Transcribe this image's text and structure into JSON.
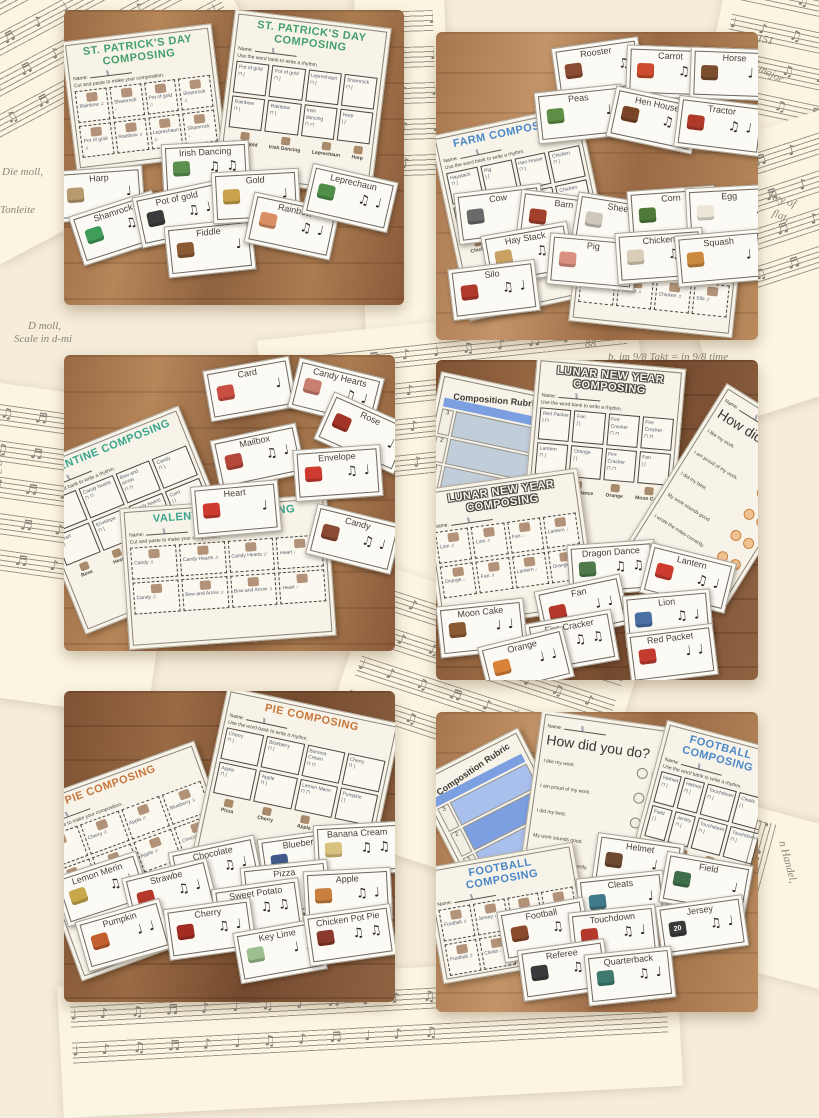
{
  "labels": {
    "name": "Name:",
    "wordbank_instruction": "Use the word bank to write a rhythm.",
    "cutpaste_instruction": "Cut and paste to make your composition."
  },
  "shared": {
    "rubric": {
      "title": "Composition Rubric",
      "scores": [
        "3",
        "2",
        "1"
      ]
    },
    "survey": {
      "title": "How did you do?",
      "items": [
        "I like my work.",
        "I am proud of my work.",
        "I did my best.",
        "My work sounds good.",
        "I wrote the notes correctly."
      ]
    }
  },
  "decor": {
    "notes": "♩ ♪ ♫ ♬ ♪ ♩ ♫ ♪ ♬ ♩ ♪ ♫",
    "fragments": [
      "151",
      "major",
      "Key of",
      "flat,",
      "88",
      "b. im 9/8 Takt = in 9/8 time",
      "Die moll,",
      "Tonleite",
      "D moll,",
      "Scale in d-mi",
      "1 2 3 4",
      "moll.",
      "art von",
      "le in d-mi",
      "n Handel,"
    ]
  },
  "photos": {
    "stpatricks": {
      "title": "St. Patrick's Day Composing",
      "title_color": "#44a06b",
      "wordbank_cells": [
        "Pot of gold\n⊓ |",
        "Pot of gold\n⊓ |",
        "Leprechaun\n⊓ |",
        "Shamrock\n⊓ |",
        "Rainbow\n⊓ |",
        "Rainbow\n⊓ |",
        "Irish dancing\n⊓ ⊓",
        "Harp\n| |"
      ],
      "cutpaste_cells": [
        "Rainbow ♫",
        "Shamrock ♩",
        "Pot of gold ♫",
        "Shamrock ♫",
        "Pot of gold ♫",
        "Rainbow ♫",
        "Leprechaun ♫",
        "Shamrock ♩"
      ],
      "wordbank_row": [
        "Pot of gold",
        "Irish Dancing",
        "Leprechaun",
        "Harp"
      ],
      "cards": [
        {
          "label": "Irish Dancing",
          "rhythm": "♫ ♫",
          "color": "#5a8f4f"
        },
        {
          "label": "Harp",
          "rhythm": "♩",
          "color": "#b79b6e"
        },
        {
          "label": "Shamrock",
          "rhythm": "♫ ♩",
          "color": "#3f9c5a"
        },
        {
          "label": "Pot of gold",
          "rhythm": "♫ ♩",
          "color": "#3a3a3a"
        },
        {
          "label": "Fiddle",
          "rhythm": "♩",
          "color": "#8a5a33"
        },
        {
          "label": "Gold",
          "rhythm": "♩",
          "color": "#c9a24b"
        },
        {
          "label": "Rainbow",
          "rhythm": "♫ ♩",
          "color": "#d98f64"
        },
        {
          "label": "Leprechaun",
          "rhythm": "♫ ♩",
          "color": "#4f8f4a"
        }
      ]
    },
    "farm": {
      "title": "Farm Composing",
      "title_color": "#4a87c7",
      "wordbank_cells": [
        "Haystack\n⊓ |",
        "Pig\n| |",
        "Hen House\n⊓ |",
        "Chicken\n⊓ |",
        "Barn\n| |",
        "Barn\n| |",
        "Corn\n| |",
        "Chicken\n⊓ |"
      ],
      "cutpaste_cells": [
        "Cow ♩",
        "Pig ♩",
        "Barn ♩",
        "Horse ♩",
        "Barn ♩",
        "Tractor ♫",
        "Chicken ♫",
        "Silo ♫"
      ],
      "wordbank_row": [
        "Chicken",
        "Tractor",
        "Haystack",
        "Silo"
      ],
      "cards": [
        {
          "label": "Rooster",
          "rhythm": "♫",
          "color": "#8a4b33"
        },
        {
          "label": "Carrot",
          "rhythm": "♫ ♩",
          "color": "#cc4b2e"
        },
        {
          "label": "Horse",
          "rhythm": "♩ ♩",
          "color": "#7a4e2f"
        },
        {
          "label": "Peas",
          "rhythm": "♩",
          "color": "#5f8f46"
        },
        {
          "label": "Hen House",
          "rhythm": "♫ ♩",
          "color": "#7a4527"
        },
        {
          "label": "Tractor",
          "rhythm": "♫ ♩",
          "color": "#b03a2a"
        },
        {
          "label": "Cow",
          "rhythm": "♩",
          "color": "#6a6a6a"
        },
        {
          "label": "Barn",
          "rhythm": "♩",
          "color": "#a3402c"
        },
        {
          "label": "Sheep",
          "rhythm": "♩",
          "color": "#cfc9bd"
        },
        {
          "label": "Corn",
          "rhythm": "♩",
          "color": "#4f7a3a"
        },
        {
          "label": "Egg",
          "rhythm": "♩",
          "color": "#ece6d8"
        },
        {
          "label": "Hay Stack",
          "rhythm": "♫ ♩",
          "color": "#c9a163"
        },
        {
          "label": "Pig",
          "rhythm": "♩",
          "color": "#d9907f"
        },
        {
          "label": "Chicken",
          "rhythm": "♫ ♩",
          "color": "#d9cdb8"
        },
        {
          "label": "Squash",
          "rhythm": "♩",
          "color": "#cc8a3f"
        },
        {
          "label": "Silo",
          "rhythm": "♫ ♩",
          "color": "#b03a2a"
        }
      ]
    },
    "valentine": {
      "title": "Valentine Composing",
      "title_color": "#3aa58c",
      "wordbank_cells": [
        "Candy\n| |",
        "Candy hearts\n⊓ ⊓",
        "Bow and arrow\n⊓ ⊓",
        "Candy\n⊓ |",
        "Heart\n| |",
        "Envelope\n⊓ |",
        "Candy hearts\n⊓ ⊓",
        "Card\n| |"
      ],
      "cutpaste_cells": [
        "Candy ♫",
        "Candy Hearts ♫",
        "Candy Hearts ♫",
        "Heart ♩",
        "Candy ♫",
        "Bow and Arrow ♫",
        "Bow and Arrow ♫",
        "Heart ♩"
      ],
      "wordbank_row": [
        "Rose",
        "Heart",
        "Card",
        "Candy Hearts"
      ],
      "cards": [
        {
          "label": "Card",
          "rhythm": "♩",
          "color": "#c94f42"
        },
        {
          "label": "Candy Hearts",
          "rhythm": "♫ ♩",
          "color": "#c97f6f"
        },
        {
          "label": "Rose",
          "rhythm": "♩",
          "color": "#a33327"
        },
        {
          "label": "Mailbox",
          "rhythm": "♫ ♩",
          "color": "#b5473a"
        },
        {
          "label": "Envelope",
          "rhythm": "♫ ♩",
          "color": "#cc3b2e"
        },
        {
          "label": "Heart",
          "rhythm": "♩",
          "color": "#cc3b2e"
        },
        {
          "label": "Candy",
          "rhythm": "♫ ♩",
          "color": "#8a4a33"
        }
      ]
    },
    "lunar": {
      "title": "Lunar New Year Composing",
      "title_color": "#f7f3e9",
      "wordbank_cells": [
        "Red Packet\n| ⊓",
        "Fan\n| |",
        "Fire Cracker\n⊓ ⊓",
        "Fire Cracker\n⊓ ⊓",
        "Lantern\n⊓ |",
        "Orange\n| |",
        "Fire Cracker\n⊓ ⊓",
        "Fan\n| |"
      ],
      "cutpaste_cells": [
        "Lion ♫",
        "Lion ♫",
        "Fan ♩",
        "Lantern ♩",
        "Orange ♩",
        "Fan ♫",
        "Lantern ♩",
        "Orange ♩"
      ],
      "wordbank_row": [
        "Fan",
        "Dragon Dance",
        "Orange",
        "Moon Cake"
      ],
      "cards": [
        {
          "label": "Dragon Dance",
          "rhythm": "♫ ♫",
          "color": "#4f7a4a"
        },
        {
          "label": "Lantern",
          "rhythm": "♫ ♩",
          "color": "#cc3b2e"
        },
        {
          "label": "Fan",
          "rhythm": "♩ ♩",
          "color": "#b5382c"
        },
        {
          "label": "Lion",
          "rhythm": "♫ ♩",
          "color": "#4a6fa3"
        },
        {
          "label": "Moon Cake",
          "rhythm": "♩ ♩",
          "color": "#8a5a33"
        },
        {
          "label": "Fire Cracker",
          "rhythm": "♫ ♫",
          "color": "#b5382c"
        },
        {
          "label": "Orange",
          "rhythm": "♩ ♩",
          "color": "#d9823a"
        },
        {
          "label": "Red Packet",
          "rhythm": "♩ ♩",
          "color": "#c23b2e"
        }
      ]
    },
    "pie": {
      "title": "Pie Composing",
      "title_color": "#c8763a",
      "wordbank_cells": [
        "Cherry\n⊓ |",
        "Blueberry\n⊓ |",
        "Banana Cream\n⊓ ⊓",
        "Cherry\n⊓ |",
        "Apple\n⊓ |",
        "Apple\n⊓ |",
        "Lemon Merin\n⊓ ⊓",
        "Pumpkin\n| |"
      ],
      "cutpaste_cells": [
        "Pizza ♫",
        "Cherry ♫",
        "Apple ♫",
        "Blueberry ♫",
        "Pizza ♫",
        "Cherry ♫",
        "Apple ♫",
        "Chocolate ♫"
      ],
      "wordbank_row": [
        "Pizza",
        "Cherry",
        "Apple",
        "Blueberry"
      ],
      "cards": [
        {
          "label": "Chocolate",
          "rhythm": "♫ ♩",
          "color": "#5f3a27"
        },
        {
          "label": "Blueberry",
          "rhythm": "♫ ♩",
          "color": "#3f5a8a"
        },
        {
          "label": "Banana Cream",
          "rhythm": "♫ ♫",
          "color": "#d9c27f"
        },
        {
          "label": "Pizza",
          "rhythm": "♫",
          "color": "#c9803f"
        },
        {
          "label": "Lemon Merin",
          "rhythm": "♫ ♩",
          "color": "#c9a84b"
        },
        {
          "label": "Strawbe",
          "rhythm": "♫ ♩",
          "color": "#b5382c"
        },
        {
          "label": "Sweet Potato",
          "rhythm": "♫ ♫",
          "color": "#b54b33"
        },
        {
          "label": "Apple",
          "rhythm": "♫ ♩",
          "color": "#c9803f"
        },
        {
          "label": "Pumpkin",
          "rhythm": "♩ ♩",
          "color": "#c25f2e"
        },
        {
          "label": "Cherry",
          "rhythm": "♫ ♩",
          "color": "#a32c22"
        },
        {
          "label": "Key Lime",
          "rhythm": "♩ ♩",
          "color": "#9cbf8f"
        },
        {
          "label": "Chicken Pot Pie",
          "rhythm": "♫ ♫",
          "color": "#8a3a2c"
        }
      ]
    },
    "football": {
      "title": "Football Composing",
      "title_color": "#4a87c7",
      "wordbank_cells": [
        "Helmet\n⊓ |",
        "Helmet\n⊓ |",
        "Touchdown\n⊓ |",
        "Cleats\n| |",
        "Field\n| |",
        "Jersey\n⊓ |",
        "Touchdown\n⊓ |",
        "Touchdown\n⊓ |"
      ],
      "cutpaste_cells": [
        "Football ♫",
        "Jersey ♩",
        "Football ♩",
        "Helmet ♫",
        "Football ♫",
        "Cleats ♩",
        "Referee ♫",
        "Field ♩"
      ],
      "wordbank_row": [
        "Football",
        "Touchdown",
        "Cleats",
        "Helmet"
      ],
      "cards": [
        {
          "label": "Helmet",
          "rhythm": "♩ ♩",
          "color": "#6f4a33"
        },
        {
          "label": "Cleats",
          "rhythm": "♩",
          "color": "#3f7a8a"
        },
        {
          "label": "Field",
          "rhythm": "♩",
          "color": "#3f6f4a"
        },
        {
          "label": "Football",
          "rhythm": "♫ ♩",
          "color": "#8a4a2c"
        },
        {
          "label": "Touchdown",
          "rhythm": "♫ ♩",
          "color": "#b5382c"
        },
        {
          "label": "Jersey",
          "rhythm": "♫ ♩",
          "color": "#3a3a3a",
          "badge": "20"
        },
        {
          "label": "Referee",
          "rhythm": "♫ ♩",
          "color": "#3a3a3a"
        },
        {
          "label": "Quarterback",
          "rhythm": "♫ ♩",
          "color": "#3f7a6f"
        }
      ]
    }
  }
}
